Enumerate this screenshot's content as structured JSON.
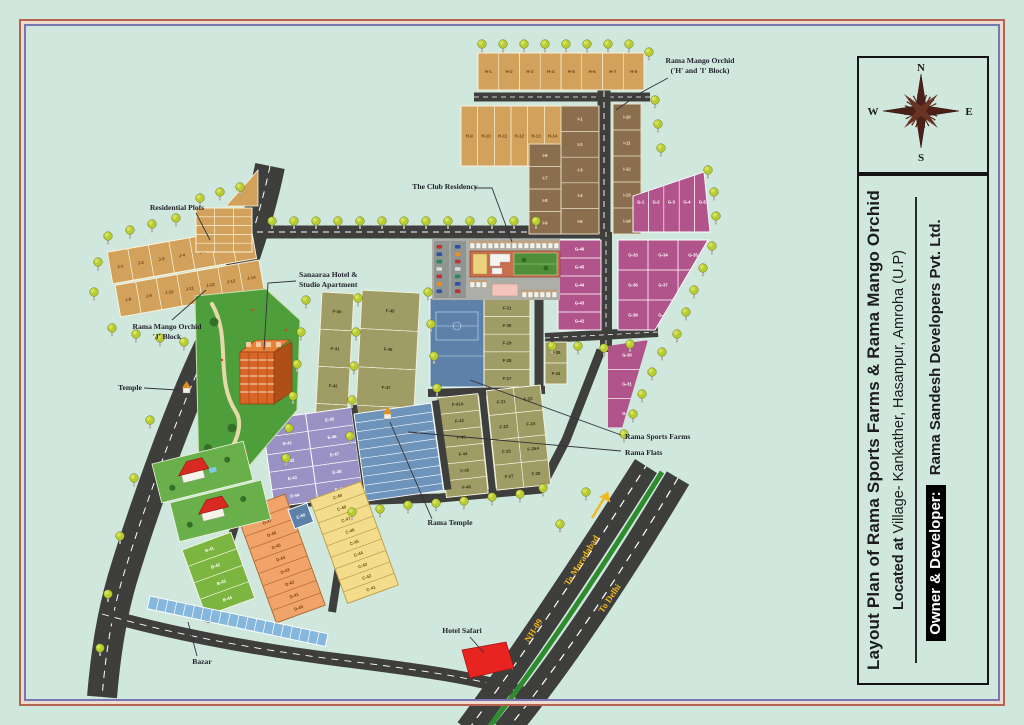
{
  "title_panel": {
    "line1": "Layout Plan of Rama Sports Farms & Rama Mango Orchid",
    "line2_bold": "Located at",
    "line2_rest": " Village- Kankather, Hasanpur, Amroha (U.P)",
    "owner_label": "Owner & Developer:",
    "owner_value": " Rama Sandesh Developers Pvt. Ltd."
  },
  "compass": {
    "north": "N",
    "east": "E",
    "south": "S",
    "west": "W"
  },
  "callouts": {
    "mango_orchid_hi": {
      "line1": "Rama Mango Orchid",
      "line2": "('H' and 'I' Block)"
    },
    "club_residency": {
      "text": "The Club Residency"
    },
    "residential_plots": {
      "text": "Residential Plots"
    },
    "mango_orchid_j": {
      "line1": "Rama Mango Orchid",
      "line2": "'J' Block"
    },
    "sanaaraa": {
      "line1": "Sanaaraa Hotel &",
      "line2": "Studio Apartment"
    },
    "temple": {
      "text": "Temple"
    },
    "sports_farms": {
      "text": "Rama Sports Farms"
    },
    "flats": {
      "text": "Rama Flats"
    },
    "rama_temple": {
      "text": "Rama Temple"
    },
    "hotel_safari": {
      "text": "Hotel Safari"
    },
    "bazar": {
      "text": "Bazar"
    }
  },
  "road_labels": {
    "nh09": "NH-09",
    "to_moradabad": "To Moradabad",
    "to_delhi": "To Delhi"
  },
  "palette": {
    "background": "#cfe7dc",
    "road": "#3e3e3c",
    "tree_crown": "#b8cc32",
    "highway_label": "#efb820",
    "median_green": "#2e8b2e",
    "frame_red": "#b5654f",
    "frame_blue": "#7878b0",
    "hotel_safari_red": "#e82420"
  },
  "blocks": {
    "hi_row1": {
      "fill": "#d2a25c",
      "stroke": "#fbf3dd",
      "label_fill": "#7a4418",
      "plots": [
        "H-1",
        "H-2",
        "H-3",
        "H-4",
        "H-5",
        "H-6",
        "H-7",
        "H-8"
      ]
    },
    "hi_row2": {
      "fill": "#d2a25c",
      "stroke": "#fbf3dd",
      "label_fill": "#7a4418",
      "plots": [
        "H-9",
        "H-10",
        "H-11",
        "H-12",
        "H-13",
        "H-14"
      ]
    },
    "i_col_a": {
      "fill": "#8a6e4e",
      "stroke": "#e9e1c9",
      "label_fill": "#f2ead2",
      "plots": [
        "I-1",
        "I-2",
        "I-3",
        "I-4",
        "I-5"
      ]
    },
    "i_col_b": {
      "fill": "#8a6e4e",
      "stroke": "#e9e1c9",
      "label_fill": "#f2ead2",
      "plots": [
        "I-6",
        "I-7",
        "I-8",
        "I-9"
      ]
    },
    "i_col_c": {
      "fill": "#8a6e4e",
      "stroke": "#e9e1c9",
      "label_fill": "#f2ead2",
      "plots": [
        "I-10",
        "I-11",
        "I-12",
        "I-13",
        "I-14"
      ]
    },
    "g_strips": {
      "fill": "#b2548c",
      "stroke": "#ffffff",
      "label_fill": "#ffffff",
      "plots": [
        "G-1",
        "G-2",
        "G-3",
        "G-4",
        "G-5"
      ]
    },
    "g_col": {
      "fill": "#b2548c",
      "stroke": "#ffffff",
      "label_fill": "#ffffff",
      "plots": [
        "G-46",
        "G-45",
        "G-44",
        "G-43",
        "G-42"
      ]
    },
    "g_wedge": {
      "fill": "#b2548c",
      "stroke": "#ffffff",
      "label_fill": "#ffffff",
      "plots": [
        "G-33",
        "G-34",
        "G-35",
        "G-36",
        "G-37",
        "G-38",
        "G-39",
        "G-40",
        "G-41"
      ]
    },
    "g_tail": {
      "fill": "#b2548c",
      "stroke": "#ffffff",
      "label_fill": "#ffffff",
      "plots": [
        "G-30",
        "G-31",
        "G-32"
      ]
    },
    "f_col_a": {
      "fill": "#a09c66",
      "stroke": "#f5f2e0",
      "label_fill": "#3a351a",
      "plots": [
        "F-40",
        "F-41",
        "F-42",
        "F-43",
        "F-44"
      ]
    },
    "f_col_b": {
      "fill": "#a09c66",
      "stroke": "#f5f2e0",
      "label_fill": "#3a351a",
      "plots": [
        "F-45",
        "F-46",
        "F-47",
        "F-48",
        "F-49"
      ]
    },
    "f_col_mid": {
      "fill": "#a09c66",
      "stroke": "#f5f2e0",
      "label_fill": "#3a351a",
      "plots": [
        "F-31",
        "F-30",
        "F-29",
        "F-28",
        "F-27",
        "F-26"
      ]
    },
    "f_small": {
      "fill": "#a09c66",
      "stroke": "#f5f2e0",
      "label_fill": "#3a351a",
      "plots": [
        "F-35",
        "F-34"
      ]
    },
    "f_bottom_a": {
      "fill": "#a09c66",
      "stroke": "#f5f2e0",
      "label_fill": "#3a351a",
      "plots": [
        "F-41A",
        "F-42",
        "F-43",
        "F-44",
        "F-45",
        "F-46"
      ]
    },
    "f_bottom_b": {
      "fill": "#a09c66",
      "stroke": "#f5f2e0",
      "label_fill": "#3a351a",
      "plots": [
        "F-21",
        "F-22",
        "F-23",
        "F-24",
        "F-25",
        "F-26A",
        "F-27",
        "F-28"
      ]
    },
    "e_col_a": {
      "fill": "#9a91c4",
      "stroke": "#ffffff",
      "label_fill": "#ffffff",
      "plots": [
        "E-40",
        "E-41",
        "E-42",
        "E-43",
        "E-44"
      ]
    },
    "e_col_b": {
      "fill": "#9a91c4",
      "stroke": "#ffffff",
      "label_fill": "#ffffff",
      "plots": [
        "E-45",
        "E-46",
        "E-47",
        "E-48",
        "E-49"
      ]
    },
    "d_col": {
      "fill": "#f0a469",
      "stroke": "#b56a30",
      "label_fill": "#823a10",
      "plots": [
        "D-48",
        "D-47",
        "D-46",
        "D-45",
        "D-44",
        "D-43",
        "D-42",
        "D-41",
        "D-40"
      ]
    },
    "c_col": {
      "fill": "#f3dd8d",
      "stroke": "#bda04a",
      "label_fill": "#6e5410",
      "plots": [
        "C-49",
        "C-48",
        "C-47",
        "C-46",
        "C-45",
        "C-44",
        "C-43",
        "C-42",
        "C-41"
      ]
    },
    "c50": {
      "fill": "#5d81a9",
      "stroke": "#ffffff",
      "label_fill": "#ffffff",
      "plots": [
        "C-50"
      ]
    },
    "b_col": {
      "fill": "#7cb53f",
      "stroke": "#f2f7e2",
      "label_fill": "#ffffff",
      "plots": [
        "B-41",
        "B-42",
        "B-43",
        "B-44"
      ]
    },
    "j_row1": {
      "fill": "#d2a25c",
      "stroke": "#fbf3dd",
      "label_fill": "#7a4418",
      "plots": [
        "J-1",
        "J-2",
        "J-3",
        "J-4",
        "J-5",
        "J-6",
        "J-7"
      ]
    },
    "j_row2": {
      "fill": "#d2a25c",
      "stroke": "#fbf3dd",
      "label_fill": "#7a4418",
      "plots": [
        "J-8",
        "J-9",
        "J-10",
        "J-11",
        "J-12",
        "J-13",
        "J-14"
      ]
    },
    "residential": {
      "fill": "#d2a25c",
      "stroke": "#fbf3dd",
      "label_fill": "#7a4418",
      "plots": []
    },
    "bazar_shops": {
      "fill": "#85b8dc",
      "stroke": "#ffffff",
      "label_fill": "#ffffff",
      "plots": []
    }
  }
}
